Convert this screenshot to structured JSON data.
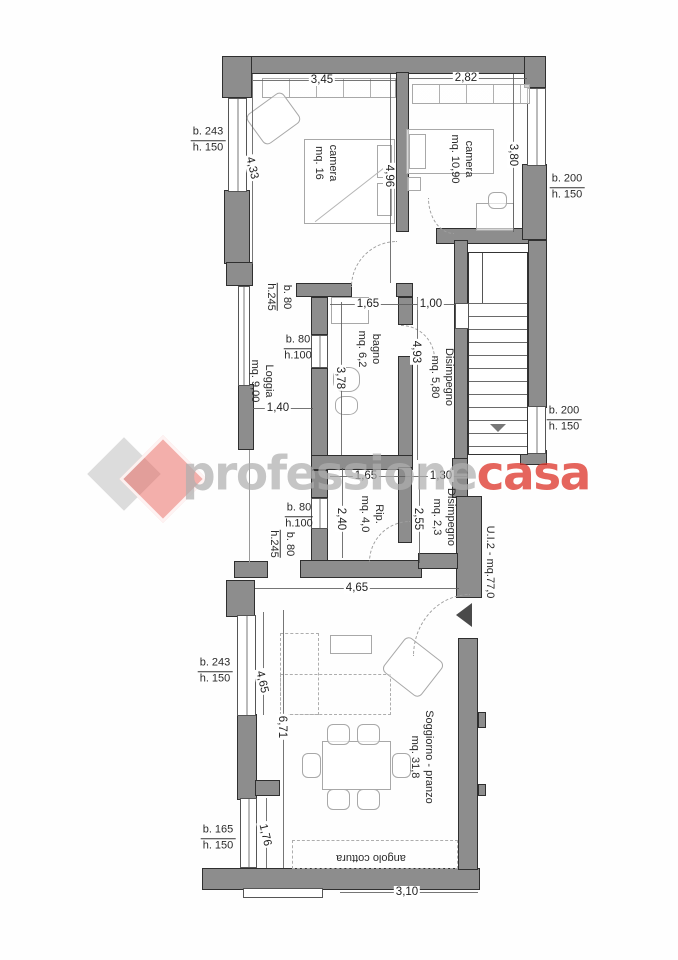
{
  "watermark": {
    "gray_text": "professione",
    "red_text": "casa",
    "gray_color": "#c9c9c9",
    "red_color": "#e2504a"
  },
  "unit_label": "U.I.2 - mq.77,0",
  "rooms": {
    "camera1": {
      "name": "camera",
      "area": "mq. 16"
    },
    "camera2": {
      "name": "camera",
      "area": "mq. 10,90"
    },
    "bagno": {
      "name": "bagno",
      "area": "mq. 6,2"
    },
    "disimpegno1": {
      "name": "Disimpegno",
      "area": "mq. 5,80"
    },
    "loggia": {
      "name": "Loggia",
      "area": "mq. 9,00"
    },
    "rip": {
      "name": "Rip.",
      "area": "mq. 4,0"
    },
    "disimpegno2": {
      "name": "Disimpegno",
      "area": "mq. 2,3"
    },
    "soggiorno": {
      "name": "Soggiorno - pranzo",
      "area": "mq. 31,8"
    },
    "cottura": {
      "name": "angolo cottura"
    }
  },
  "dims": {
    "top_cam1": "3,45",
    "top_cam2": "2,82",
    "left_cam1": "4,33",
    "mid_cam": "4,96",
    "right_cam2": "3,80",
    "bagno_w": "1,65",
    "corridor_w": "1,00",
    "corridor_h": "4,93",
    "bagno_h": "3,78",
    "loggia_w": "1,40",
    "rip_w": "1,65",
    "dis2_w": "1,30",
    "rip_h": "2,40",
    "dis2_h": "2,55",
    "sogg_w": "4,65",
    "sogg_h": "6,71",
    "win_sogg": "4,65",
    "win_small": "1,76",
    "bottom_w": "3,10"
  },
  "openings": {
    "tl": {
      "b": "b. 243",
      "h": "h. 150"
    },
    "tr": {
      "b": "b. 200",
      "h": "h. 150"
    },
    "loggia_top": {
      "b": "b. 80",
      "h": "h.245"
    },
    "bagno_win": {
      "b": "b. 80",
      "h": "h.100"
    },
    "stairs_win": {
      "b": "b. 200",
      "h": "h. 150"
    },
    "rip_win": {
      "b": "b. 80",
      "h": "h.100"
    },
    "left_mid": {
      "b": "b. 80",
      "h": "h.245"
    },
    "sogg_win": {
      "b": "b. 243",
      "h": "h. 150"
    },
    "kitchen_win": {
      "b": "b. 165",
      "h": "h. 150"
    }
  }
}
